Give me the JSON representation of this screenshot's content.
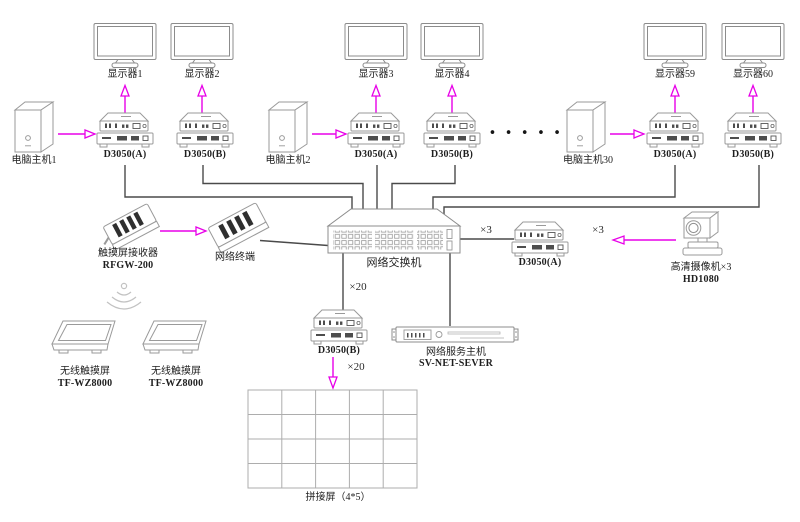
{
  "colors": {
    "arrow_magenta": "#e800e8",
    "wire_dark": "#4a4a4a",
    "device_outline": "#9a9a9a"
  },
  "groups": [
    {
      "computer": "电脑主机1",
      "units": [
        {
          "model": "D3050(A)",
          "monitor": "显示器1"
        },
        {
          "model": "D3050(B)",
          "monitor": "显示器2"
        }
      ]
    },
    {
      "computer": "电脑主机2",
      "units": [
        {
          "model": "D3050(A)",
          "monitor": "显示器3"
        },
        {
          "model": "D3050(B)",
          "monitor": "显示器4"
        }
      ]
    },
    {
      "computer": "电脑主机30",
      "units": [
        {
          "model": "D3050(A)",
          "monitor": "显示器59"
        },
        {
          "model": "D3050(B)",
          "monitor": "显示器60"
        }
      ]
    }
  ],
  "ellipsis": "•••••",
  "switch": {
    "label": "网络交换机"
  },
  "touch": {
    "receiver": {
      "name": "触摸屏接收器",
      "model": "RFGW-200"
    },
    "terminal": {
      "name": "网络终端"
    },
    "screens": [
      {
        "name": "无线触摸屏",
        "model": "TF-WZ8000"
      },
      {
        "name": "无线触摸屏",
        "model": "TF-WZ8000"
      }
    ]
  },
  "camera": {
    "name": "高清摄像机×3",
    "model": "HD1080",
    "converter": "D3050(A)",
    "switch_multiplier": "×3",
    "link_multiplier": "×3"
  },
  "decoder": {
    "model": "D3050(B)",
    "from_switch": "×20",
    "to_wall": "×20"
  },
  "server": {
    "name": "网络服务主机",
    "model": "SV-NET-SEVER"
  },
  "videowall": {
    "label": "拼接屏（4*5）",
    "rows": 4,
    "cols": 5
  },
  "icons": {
    "wifi": "wifi-signal-icon",
    "ellipsis": "continuation-dots"
  }
}
